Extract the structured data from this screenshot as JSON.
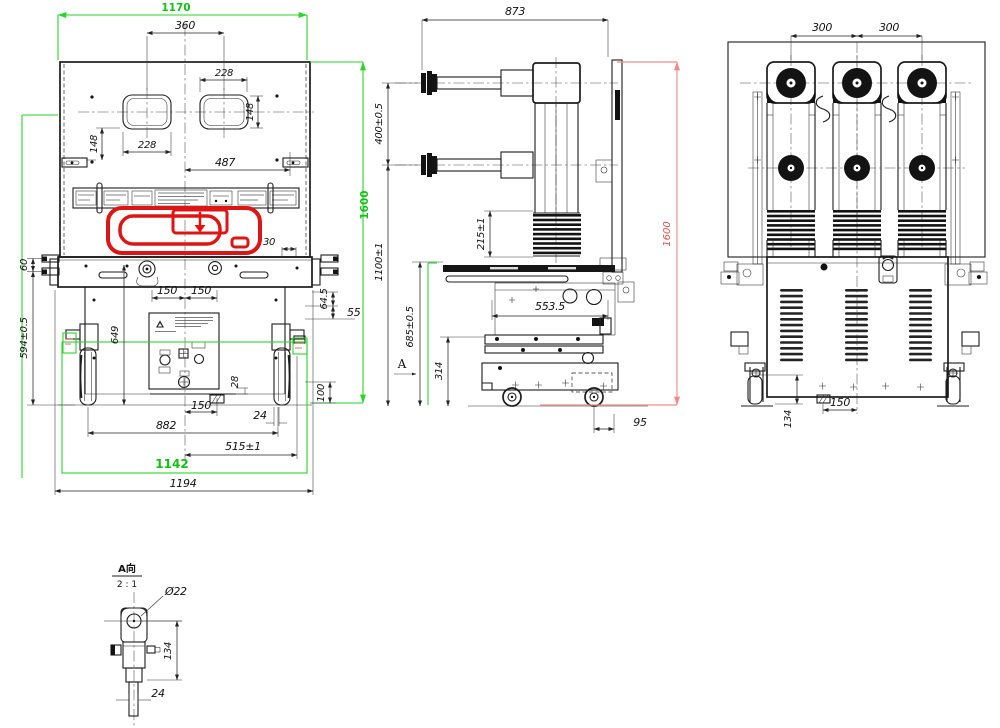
{
  "front_view": {
    "dims": {
      "top_width_green": "1170",
      "window_center_span": "360",
      "window_width_top": "228",
      "window_height_right": "148",
      "window_height_left": "148",
      "window_width_bottom": "228",
      "panel_span": "487",
      "slot_width": "30",
      "hook_step": "60",
      "lower_height": "594±0.5",
      "body_height": "649",
      "rail_left": "150",
      "rail_right": "150",
      "step_a": "64.5",
      "step_b": "55",
      "foot_height": "28",
      "bracket_height": "100",
      "foot_span": "150",
      "wheel_width": "24",
      "wheel_span": "882",
      "track_span": "515±1",
      "width_green": "1142",
      "overall_width": "1194",
      "height_green": "1600"
    }
  },
  "side_view": {
    "dims": {
      "depth": "873",
      "arm_spacing": "400±0.5",
      "bellows_height": "215±1",
      "lower_height": "1100±1",
      "chassis_height": "685±0.5",
      "frame_span": "553.5",
      "base_height": "314",
      "rear_offset": "95",
      "height_red": "1600",
      "view_arrow_label": "A"
    }
  },
  "rear_view": {
    "dims": {
      "pole_pitch_left": "300",
      "pole_pitch_right": "300",
      "foot_span": "150",
      "wheel_height": "134"
    }
  },
  "detail_view": {
    "title": "A向",
    "scale": "2 : 1",
    "hole_dia": "Ø22",
    "height": "134",
    "width": "24"
  }
}
